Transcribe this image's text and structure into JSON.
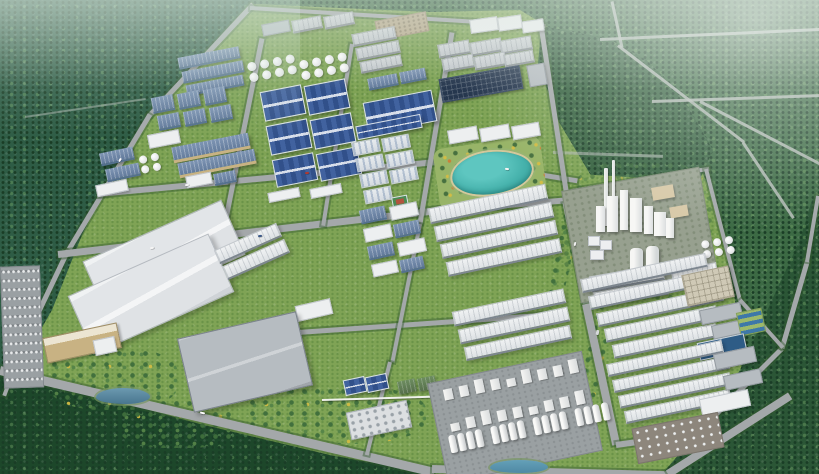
{
  "scene": {
    "type": "aerial-3d-render",
    "subject": "industrial park master plan with surrounding forest",
    "regions": [
      {
        "name": "forest-hills",
        "desc": "dense green forest surrounding the park, hazy toward the horizon"
      },
      {
        "name": "northwest-factory-zone",
        "desc": "blue-roofed factory halls, gray sheds and white tank farms"
      },
      {
        "name": "central-blue-warehouses",
        "desc": "grid of six dark-blue ridged warehouse roofs"
      },
      {
        "name": "staff-campus",
        "desc": "rows of light dormitory blocks with a green sports court"
      },
      {
        "name": "lakeside-park",
        "desc": "turquoise lake ringed by lawns, paths and flowering trees"
      },
      {
        "name": "cement-plant",
        "desc": "white process towers, two tall chimneys and paired cooling towers"
      },
      {
        "name": "eastern-warehouse-rows",
        "desc": "long white gable-roof warehouse rows in two groups"
      },
      {
        "name": "water-treatment",
        "desc": "dark-blue settling basins and striped pools"
      },
      {
        "name": "southwest-logistics",
        "desc": "giant white warehouses, tan office, car park and small pond"
      },
      {
        "name": "chemical-plant",
        "desc": "dense white process units with four rows of silos on a gray apron"
      },
      {
        "name": "road-network",
        "desc": "tree-lined boulevards, perimeter roads and forest roads"
      }
    ]
  },
  "palette": {
    "grass": "#7fa355",
    "grassLight": "#98b468",
    "grassDot": "#6a9348",
    "forestNW": "#2e5c45",
    "forestNE": "#3c6a44",
    "forestSE": "#234c2c",
    "forestSW": "#1d472a",
    "forestDot": "#1a3d26",
    "road": "#a4a8aa",
    "roadForest": "#b6bdb8",
    "roofNavy": "#31508a",
    "roofNavyLight": "#41629f",
    "roofBlueDark": "#54708f",
    "eave": "#7d868f",
    "blockGray": "#b6bcc1",
    "wallTan": "#c8b283",
    "gravel": "#b9ab8e",
    "solar": "#26374e",
    "lake": "#46b2ac",
    "lakeDeep": "#2f958f",
    "basin": "#2e5c86",
    "poolBlue": "#3e78a8",
    "apron": "#9aa0a2",
    "ground": "#97a08f",
    "accentYellow": "#d2bc45",
    "accentOrange": "#c97f3a",
    "court": "#4b8a54",
    "courtInner": "#b2543e",
    "pipe": "#eff1ec"
  }
}
